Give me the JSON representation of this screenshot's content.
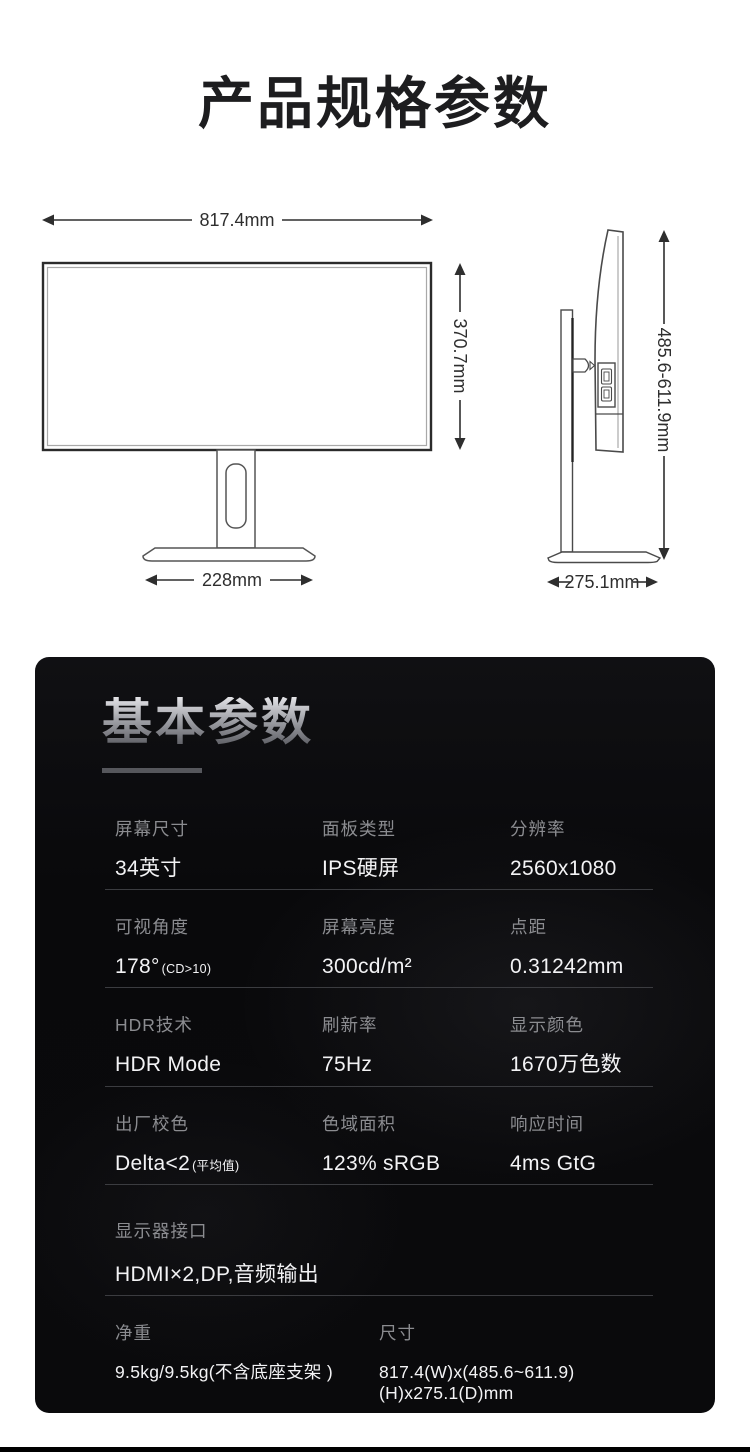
{
  "page": {
    "title": "产品规格参数"
  },
  "diagram": {
    "front": {
      "width_label": "817.4mm",
      "height_label": "370.7mm",
      "base_label": "228mm"
    },
    "side": {
      "height_label": "485.6-611.9mm",
      "depth_label": "275.1mm"
    }
  },
  "panel": {
    "heading": "基本参数",
    "rows": [
      {
        "cells": [
          {
            "label": "屏幕尺寸",
            "value": "34英寸"
          },
          {
            "label": "面板类型",
            "value": "IPS硬屏"
          },
          {
            "label": "分辨率",
            "value": "2560x1080"
          }
        ]
      },
      {
        "cells": [
          {
            "label": "可视角度",
            "value": "178°",
            "note": "(CD>10)"
          },
          {
            "label": "屏幕亮度",
            "value": "300cd/m²"
          },
          {
            "label": "点距",
            "value": "0.31242mm"
          }
        ]
      },
      {
        "cells": [
          {
            "label": "HDR技术",
            "value": "HDR Mode"
          },
          {
            "label": "刷新率",
            "value": "75Hz"
          },
          {
            "label": "显示颜色",
            "value": "1670万色数"
          }
        ]
      },
      {
        "cells": [
          {
            "label": "出厂校色",
            "value": "Delta<2",
            "note": "(平均值)"
          },
          {
            "label": "色域面积",
            "value": "123% sRGB"
          },
          {
            "label": "响应时间",
            "value": "4ms GtG"
          }
        ]
      },
      {
        "cells": [
          {
            "label": "显示器接口",
            "value": "HDMI×2,DP,音频输出"
          }
        ]
      },
      {
        "cells": [
          {
            "label": "净重",
            "value": "9.5kg/9.5kg(不含底座支架 )"
          },
          {
            "label": "尺寸",
            "value": "817.4(W)x(485.6~611.9)(H)x275.1(D)mm"
          }
        ]
      }
    ]
  }
}
